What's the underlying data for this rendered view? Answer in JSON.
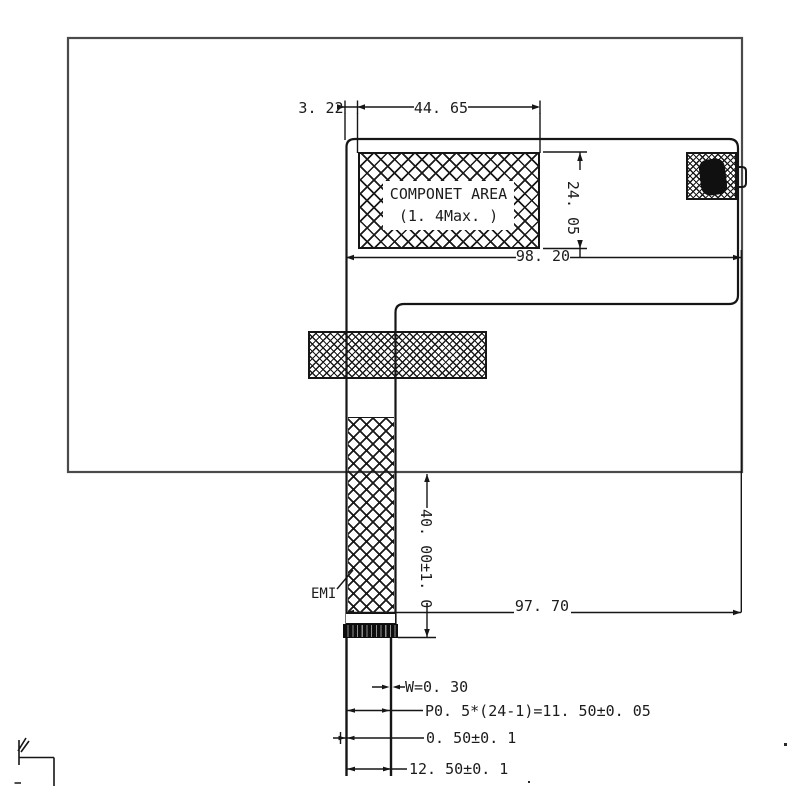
{
  "drawing": {
    "labels": {
      "component_area_title": "COMPONET AREA",
      "component_area_note": "(1. 4Max. )",
      "emi": "EMI"
    },
    "dimensions": {
      "offset_left": "3. 22",
      "component_width": "44. 65",
      "component_height": "24. 05",
      "overall_width_top": "98. 20",
      "overall_width_bottom": "97. 70",
      "fpc_length": "40. 00±1. 0",
      "contact_width": "W=0. 30",
      "contact_pitch": "P0. 5*(24-1)=11. 50±0. 05",
      "edge_margin": "0. 50±0. 1",
      "tail_width": "12. 50±0. 1"
    },
    "colors": {
      "line": "#161616",
      "outer_outline": "#4a4a4a",
      "background": "#ffffff",
      "connector_fill": "#0d0d0d"
    }
  }
}
